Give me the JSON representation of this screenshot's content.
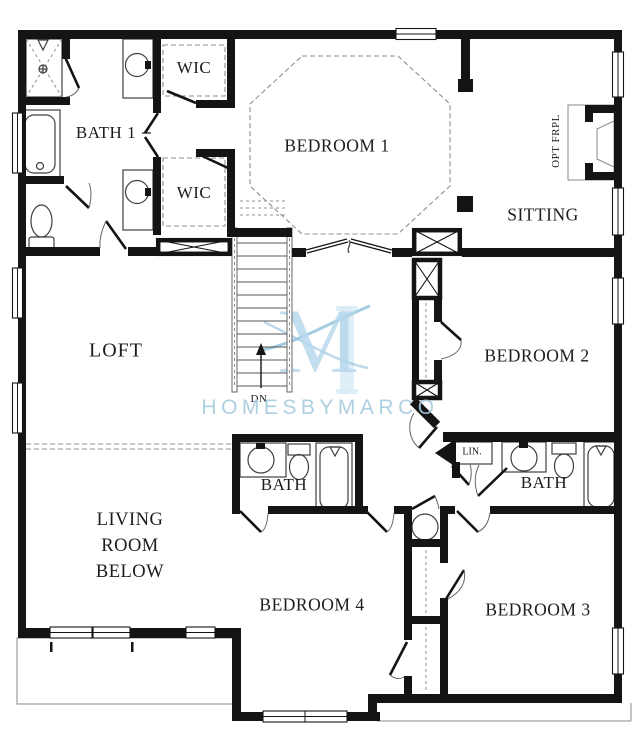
{
  "plan": {
    "rooms": {
      "bath1": "BATH 1",
      "wic_upper": "WIC",
      "wic_lower": "WIC",
      "bedroom1": "BEDROOM 1",
      "sitting": "SITTING",
      "opt_fireplace": "OPT FRPL",
      "loft": "LOFT",
      "stairs_direction": "DN",
      "bedroom2": "BEDROOM 2",
      "bath2": "BATH",
      "linen": "LIN.",
      "bath3": "BATH",
      "living_below": [
        "LIVING",
        "ROOM",
        "BELOW"
      ],
      "bedroom4": "BEDROOM 4",
      "bedroom3": "BEDROOM 3"
    },
    "watermark": {
      "wordmark": "HOMESBYMARCO",
      "monogram": "M"
    },
    "colors": {
      "wall": "#141414",
      "line": "#3f3f3f",
      "line_light": "#8a8a8a",
      "dash": "#8f8f8f",
      "watermark_text": "#a6cbdf",
      "watermark_logo": "#b5d7ea",
      "watermark_logo_light": "#dcecf6",
      "watermark_swoosh": "#8fc0da",
      "background": "#ffffff",
      "label": "#1c1c1c"
    }
  }
}
